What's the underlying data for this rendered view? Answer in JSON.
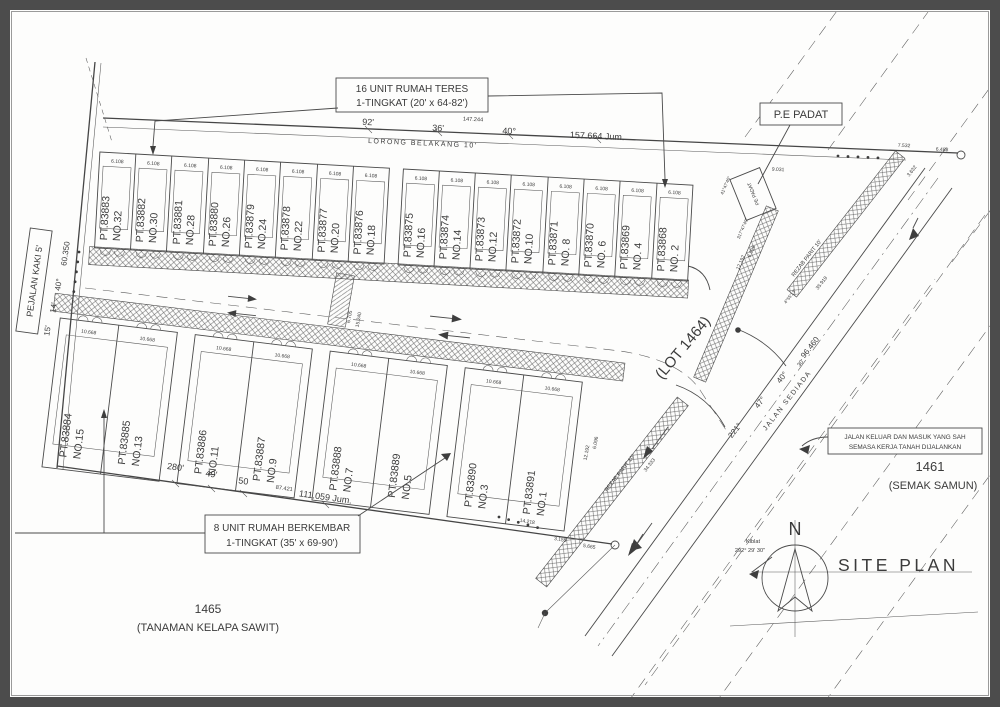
{
  "boxes": {
    "teres": {
      "line1": "16 UNIT RUMAH TERES",
      "line2": "1-TINGKAT (20' x 64-82')"
    },
    "berkembar": {
      "line1": "8 UNIT RUMAH BERKEMBAR",
      "line2": "1-TINGKAT (35' x 69-90')"
    },
    "pe_padat": "P.E PADAT",
    "jalan_keluar": {
      "line1": "JALAN KELUAR DAN MASUK YANG SAH",
      "line2": "SEMASA KERJA TANAH DIJALANKAN"
    }
  },
  "regions": {
    "lot1464": "(LOT 1464)",
    "lot1461_num": "1461",
    "lot1461_desc": "(SEMAK SAMUN)",
    "lot1465_num": "1465",
    "lot1465_desc": "(TANAMAN KELAPA SAWIT)"
  },
  "roads": {
    "lorong_belakang": "LORONG BELAKANG 10'",
    "pejalan_kaki": "PEJALAN KAKI 5'",
    "jalan_sediada": "JALAN SEDIADA",
    "rezab_parit": "REZAB PARIT 10'",
    "pe_padat_small": "PE PADAT"
  },
  "dims": {
    "top": [
      "92'",
      "36'",
      "147.244",
      "40°",
      "157.664 Jum."
    ],
    "bottom": [
      "280'",
      "49'",
      "50",
      "87.421",
      "111.059 Jum."
    ],
    "left": [
      "15'",
      "14'",
      "40°",
      "60.350"
    ],
    "sediada": [
      "221°",
      "47°",
      "40°",
      "96.460",
      "30'"
    ],
    "d6488": "6.488",
    "d7532": "7.532",
    "d3632": "3.632",
    "d9031": "9.031",
    "d12192": "12.192",
    "d6096": "6.096",
    "d35919": "35.919",
    "d34333": "34.333",
    "d14218": "14.218",
    "d5665": "5.665",
    "d3155": "3.155",
    "d6705": "6.705",
    "d15240": "15.240",
    "b45513": "4°55'13\"",
    "b414740": "41°47'40\"",
    "b3174740": "317°47'40\""
  },
  "lots": {
    "top_width": "6.108",
    "bottom_width": "10.668",
    "top": [
      {
        "pt": "PT.83883",
        "no": "NO.32"
      },
      {
        "pt": "PT.83882",
        "no": "NO.30"
      },
      {
        "pt": "PT.83881",
        "no": "NO.28"
      },
      {
        "pt": "PT.83880",
        "no": "NO.26"
      },
      {
        "pt": "PT.83879",
        "no": "NO.24"
      },
      {
        "pt": "PT.83878",
        "no": "NO.22"
      },
      {
        "pt": "PT.83877",
        "no": "NO.20"
      },
      {
        "pt": "PT.83876",
        "no": "NO.18"
      },
      {
        "pt": "PT.83875",
        "no": "NO.16"
      },
      {
        "pt": "PT.83874",
        "no": "NO.14"
      },
      {
        "pt": "PT.83873",
        "no": "NO.12"
      },
      {
        "pt": "PT.83872",
        "no": "NO.10"
      },
      {
        "pt": "PT.83871",
        "no": "NO. 8"
      },
      {
        "pt": "PT.83870",
        "no": "NO. 6"
      },
      {
        "pt": "PT.83869",
        "no": "NO. 4"
      },
      {
        "pt": "PT.83868",
        "no": "NO. 2"
      }
    ],
    "bottom": [
      {
        "pt": "PT.83884",
        "no": "NO.15"
      },
      {
        "pt": "PT.83885",
        "no": "NO.13"
      },
      {
        "pt": "PT.83886",
        "no": "NO.11"
      },
      {
        "pt": "PT.83887",
        "no": "NO.9"
      },
      {
        "pt": "PT.83888",
        "no": "NO.7"
      },
      {
        "pt": "PT.83889",
        "no": "NO.5"
      },
      {
        "pt": "PT.83890",
        "no": "NO.3"
      },
      {
        "pt": "PT.83891",
        "no": "NO.1"
      }
    ]
  },
  "compass": {
    "north": "N",
    "title": "SITE PLAN",
    "kiblat": "Kiblat",
    "kiblat_bearing": "292° 29' 30\""
  },
  "colors": {
    "line": "#4a4a4a",
    "text": "#3b3b3b",
    "frame": "#4c4c4c",
    "paper": "#fdfdfc"
  }
}
